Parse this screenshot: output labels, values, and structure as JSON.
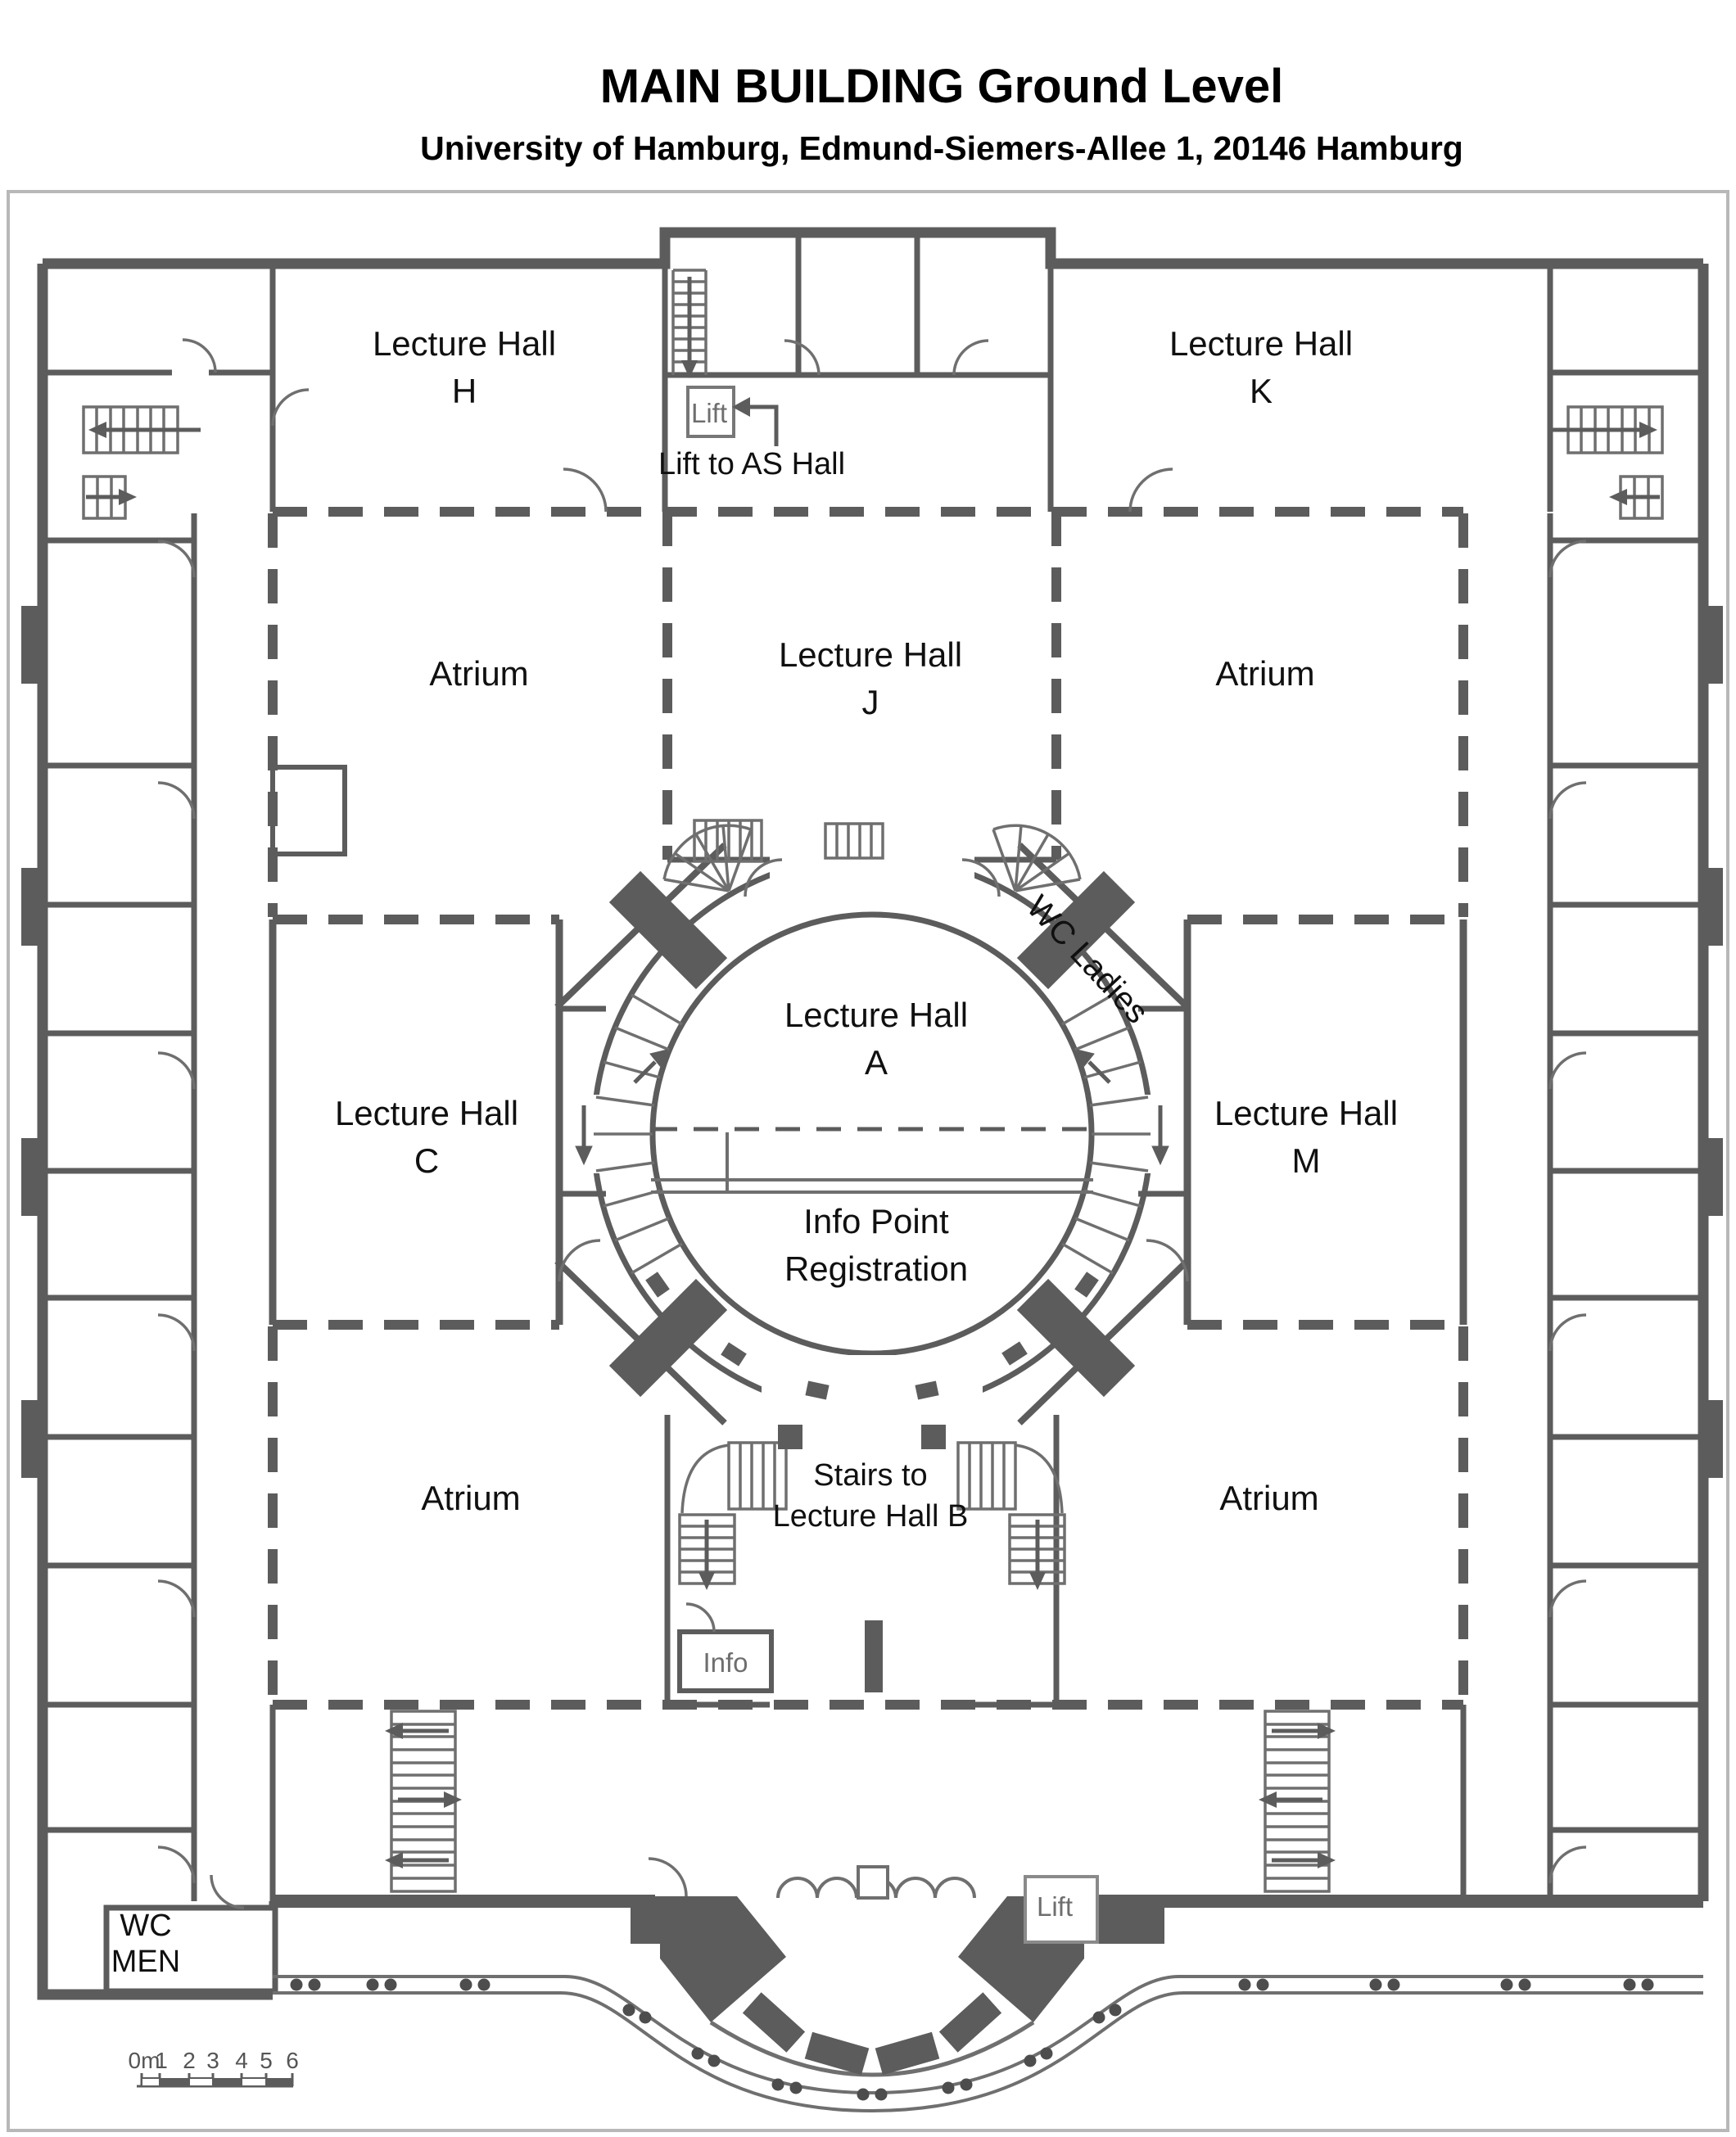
{
  "header": {
    "title": "MAIN BUILDING Ground Level",
    "subtitle": "University of Hamburg, Edmund-Siemers-Allee 1, 20146 Hamburg"
  },
  "rooms": {
    "lecture_hall_h": {
      "line1": "Lecture Hall",
      "line2": "H"
    },
    "lecture_hall_k": {
      "line1": "Lecture Hall",
      "line2": "K"
    },
    "lecture_hall_j": {
      "line1": "Lecture Hall",
      "line2": "J"
    },
    "lecture_hall_a": {
      "line1": "Lecture Hall",
      "line2": "A"
    },
    "lecture_hall_c": {
      "line1": "Lecture Hall",
      "line2": "C"
    },
    "lecture_hall_m": {
      "line1": "Lecture Hall",
      "line2": "M"
    },
    "atrium_nw": {
      "label": "Atrium"
    },
    "atrium_ne": {
      "label": "Atrium"
    },
    "atrium_sw": {
      "label": "Atrium"
    },
    "atrium_se": {
      "label": "Atrium"
    },
    "info_point": {
      "line1": "Info Point",
      "line2": "Registration"
    },
    "stairs_to_b": {
      "line1": "Stairs to",
      "line2": "Lecture Hall B"
    },
    "wc_ladies": {
      "label": "WC Ladies"
    },
    "wc_men": {
      "line1": "WC",
      "line2": "MEN"
    }
  },
  "labels": {
    "lift_top": "Lift",
    "lift_to_as_hall": "Lift to AS Hall",
    "lift_entrance": "Lift",
    "info_booth": "Info"
  },
  "scale_bar": {
    "unit_label": "0m",
    "ticks": [
      "1",
      "2",
      "3",
      "4",
      "5",
      "6"
    ]
  },
  "colors": {
    "wall": "#5c5c5c",
    "thin_line": "#6f6f6f",
    "text": "#101010",
    "muted_text": "#6e6e6e",
    "frame": "#b8b8b8",
    "background": "#ffffff"
  }
}
